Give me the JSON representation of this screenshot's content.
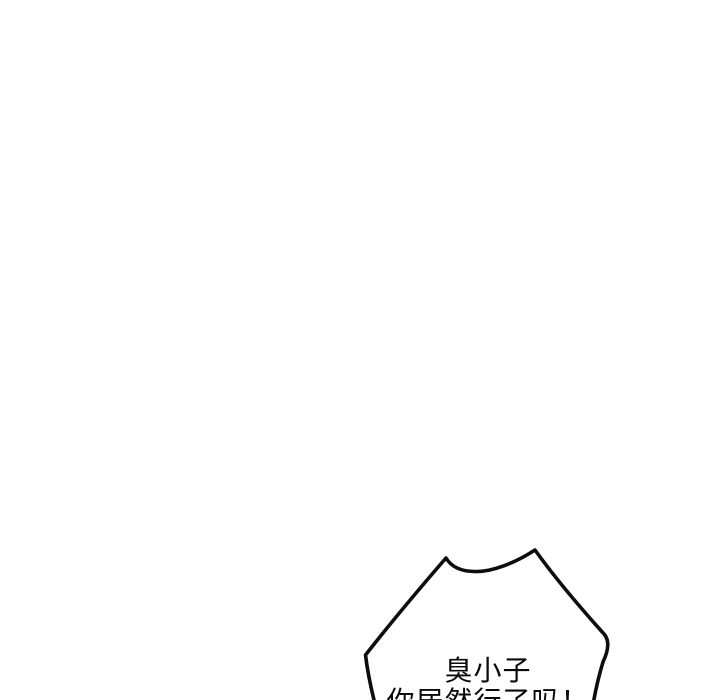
{
  "page": {
    "background": "#ffffff",
    "description": "mostly blank comic page with one speech bubble entering from bottom edge"
  },
  "colors": {
    "ink": "#0d0d0d",
    "text": "#0a0a0a",
    "bubble_fill": "#ffffff"
  },
  "speech_bubble": {
    "type": "spiky-shout-bubble",
    "clipped_at_bottom": true,
    "lines": [
      "臭小子",
      "你居然行了吗！"
    ]
  }
}
